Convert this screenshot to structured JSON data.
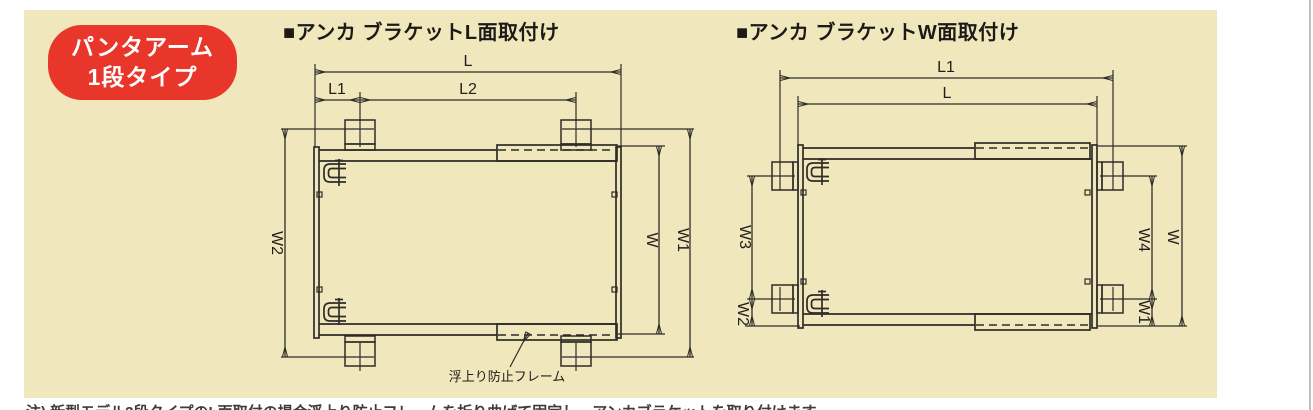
{
  "badge": {
    "line1": "パンタアーム",
    "line2": "1段タイプ"
  },
  "left_diagram": {
    "title": "■アンカ ブラケットL面取付け",
    "dim_L": "L",
    "dim_L1": "L1",
    "dim_L2": "L2",
    "dim_W": "W",
    "dim_W1": "W1",
    "dim_W2": "W2",
    "callout": "浮上り防止フレーム"
  },
  "right_diagram": {
    "title": "■アンカ ブラケットW面取付け",
    "dim_L1": "L1",
    "dim_L": "L",
    "dim_W": "W",
    "dim_W1": "W1",
    "dim_W2": "W2",
    "dim_W3": "W3",
    "dim_W4": "W4"
  },
  "note_clipped": "注) 新型モデル2段タイプのL面取付の場合浮上り防止フレームを折り曲げて固定し、アンカブラケットを取り付けます。",
  "colors": {
    "panel_bg": "#f0e7bd",
    "badge_bg": "#e8362b",
    "badge_text": "#ffffff",
    "line": "#2e2c28",
    "bracket_fill": "#f6c492",
    "bracket_foot": "#e5a668"
  }
}
